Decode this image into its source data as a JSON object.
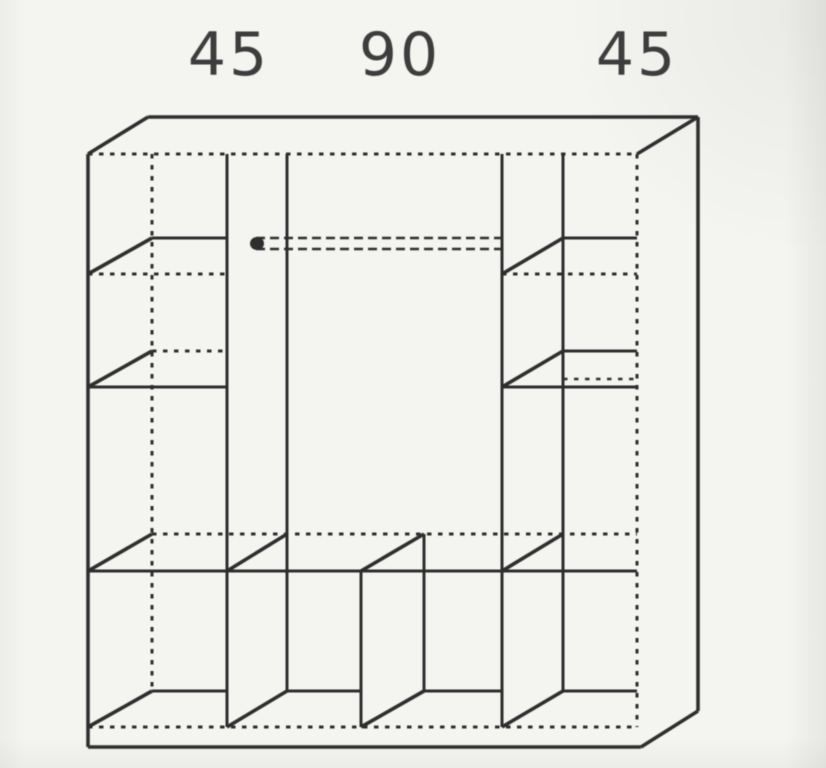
{
  "diagram": {
    "kind": "wardrobe-interior-schematic",
    "description": "Scanned line drawing of a wardrobe carcass interior in oblique projection: two shelved 45 cm side columns, a 90 cm middle section with a hanging rail, a full-width shelf above a bottom row of compartments",
    "dimension_labels": [
      {
        "position": "left",
        "text": "45"
      },
      {
        "position": "middle",
        "text": "90"
      },
      {
        "position": "right",
        "text": "45"
      }
    ],
    "sections": {
      "left_column_shelves": 3,
      "right_column_shelves": 3,
      "middle_has_hanging_rail": true,
      "bottom_row_compartments": 4
    },
    "colors": {
      "ink": "#2d2d2d",
      "label_ink": "#3e3e3e",
      "paper": "#f4f4f1"
    }
  }
}
